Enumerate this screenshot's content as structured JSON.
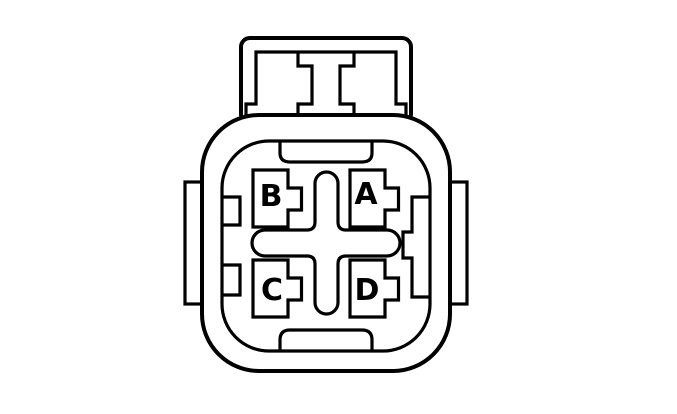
{
  "diagram": {
    "kind": "connector-pinout-face-view",
    "terminal_count": 4,
    "terminals": [
      {
        "label": "A",
        "position": "top-right"
      },
      {
        "label": "B",
        "position": "top-left"
      },
      {
        "label": "C",
        "position": "bottom-left"
      },
      {
        "label": "D",
        "position": "bottom-right"
      }
    ],
    "colors": {
      "line": "#000000",
      "background": "#ffffff"
    }
  }
}
